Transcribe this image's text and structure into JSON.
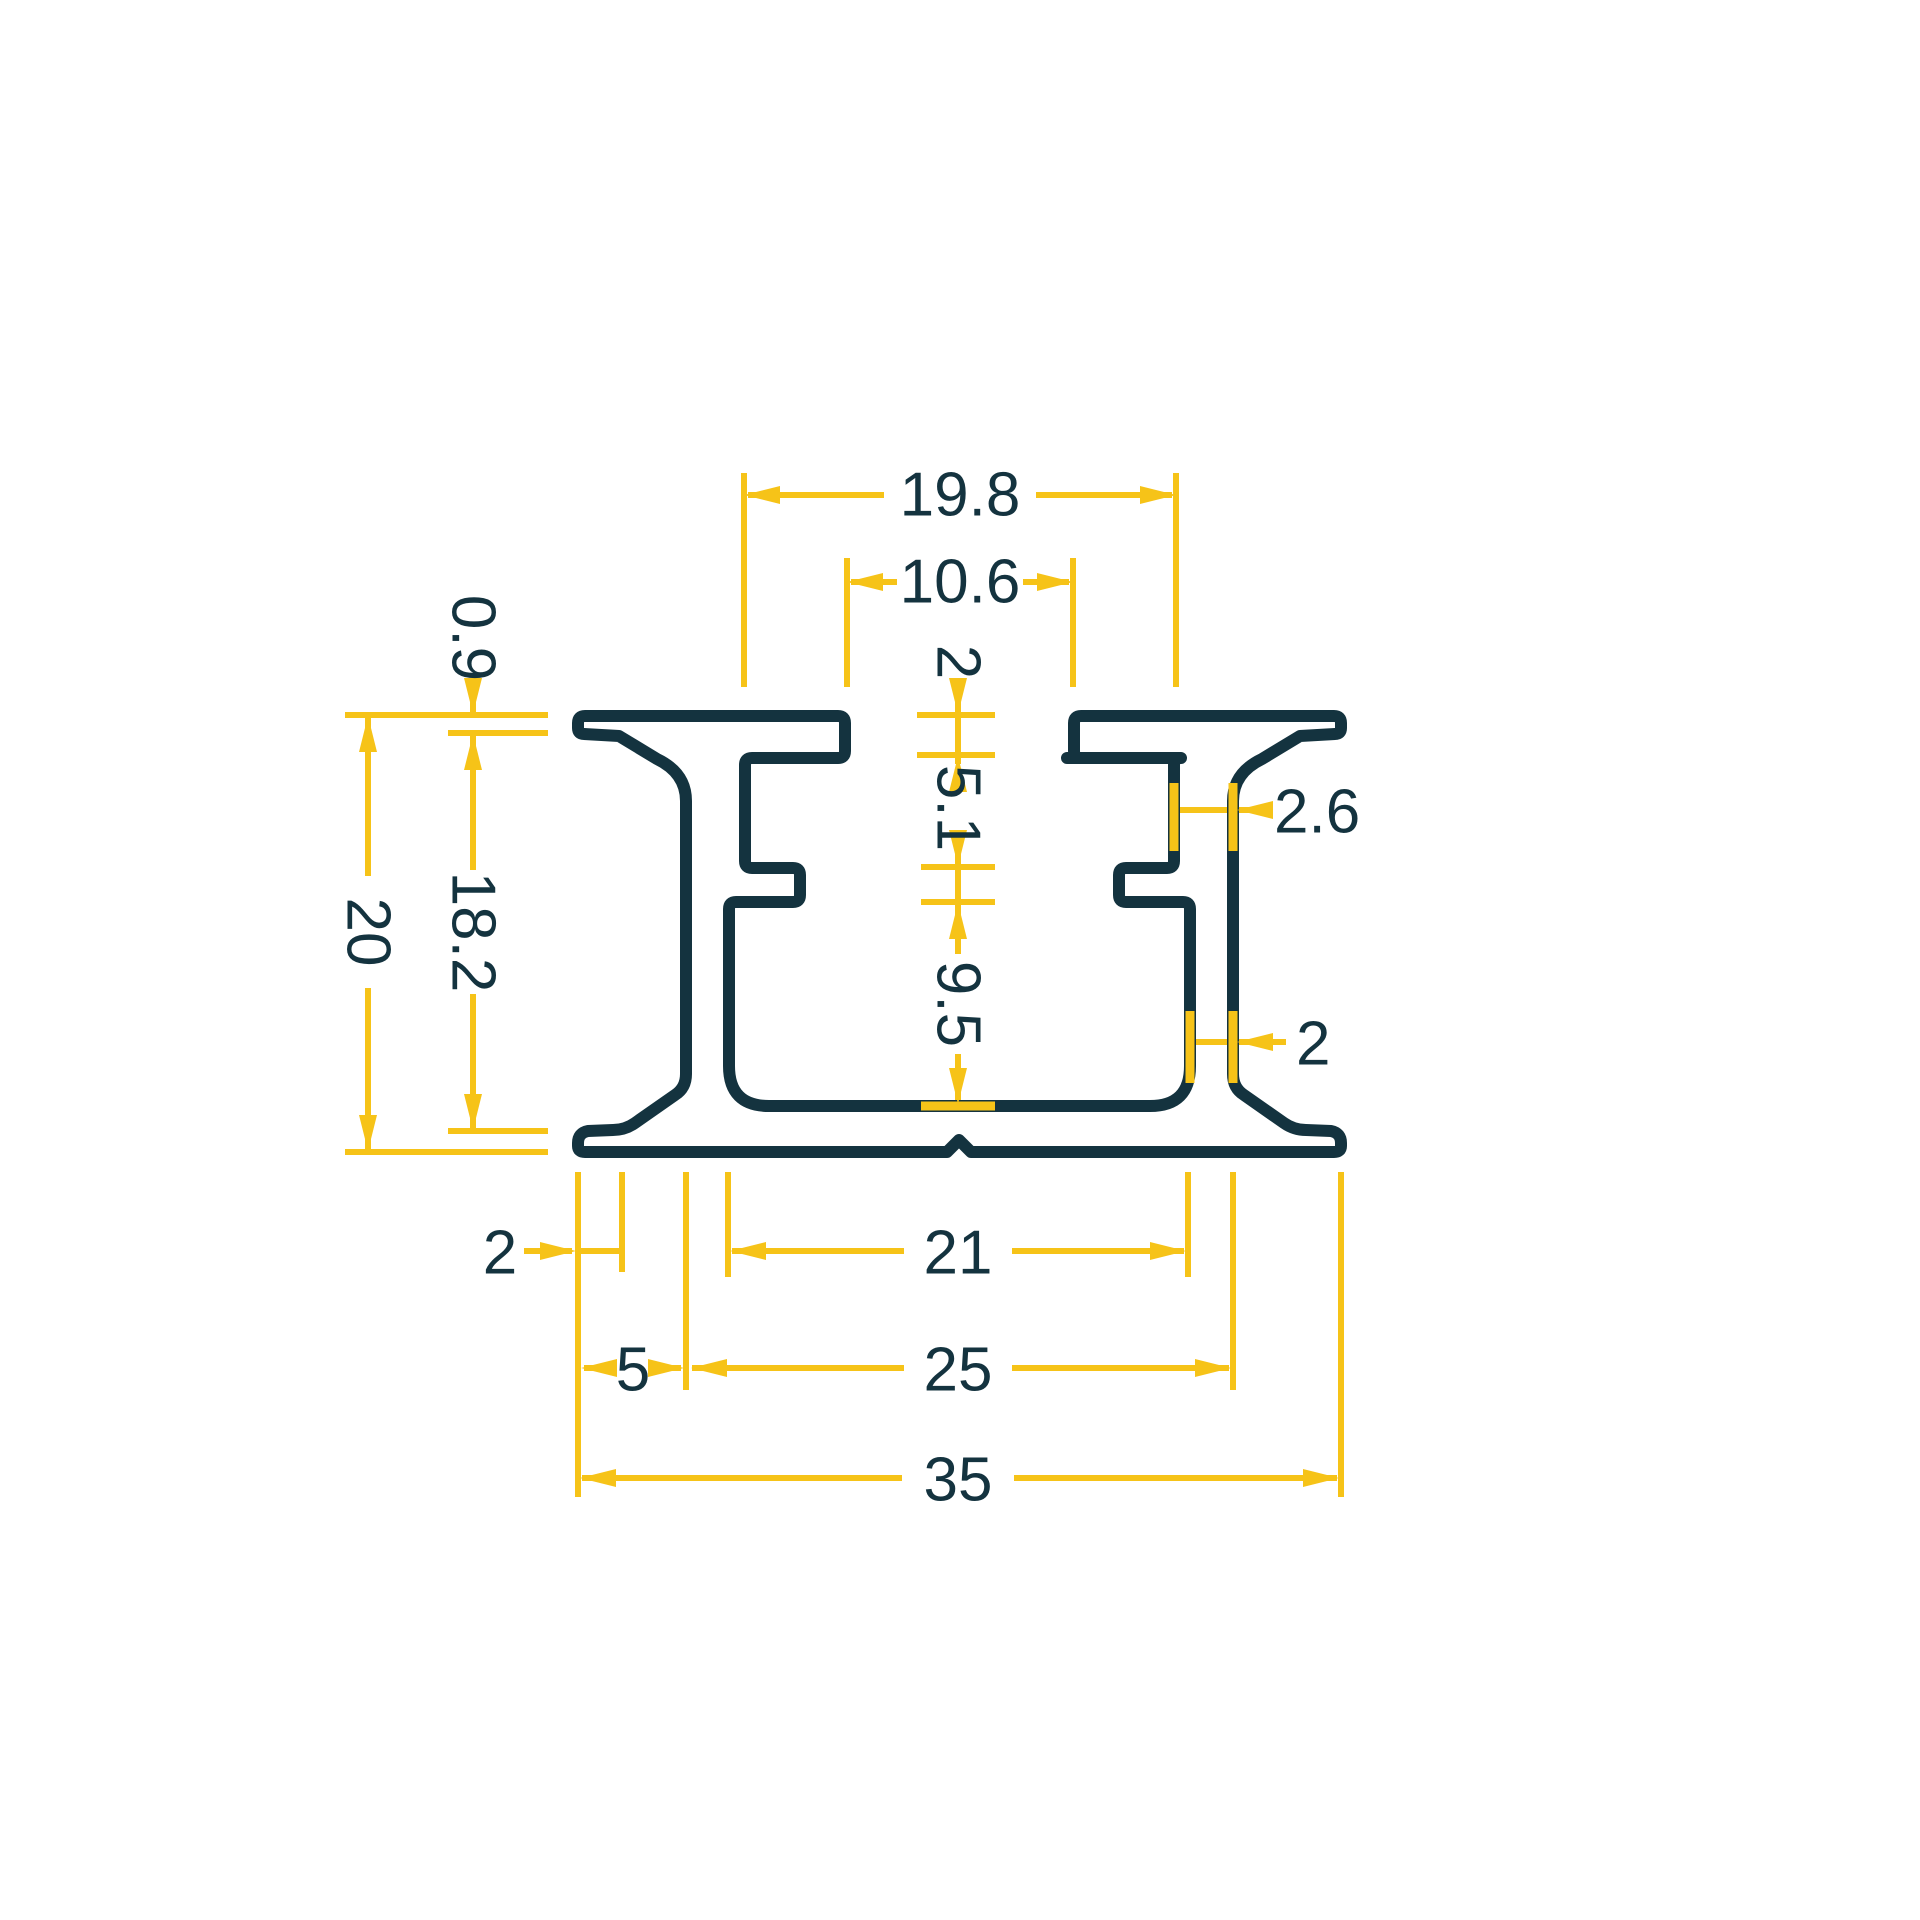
{
  "canvas": {
    "width": 1920,
    "height": 1920,
    "background": "#ffffff"
  },
  "colors": {
    "profile_stroke": "#14333F",
    "dimension": "#F6C318",
    "label_text": "#14333F"
  },
  "drawing": {
    "type": "extrusion-profile-cross-section",
    "profile_path": "M 585 716 L 838 716 Q 845 716 845 723 L 845 751 Q 845 758 838 758 L 752 758 Q 745 758 745 765 L 745 861 Q 745 868 752 868 L 793 868 Q 800 868 800 875 L 800 895 Q 800 902 793 902 L 736 902 Q 729 902 729 909 L 729 1066 Q 729 1106 769 1106 L 1150 1106 Q 1190 1106 1190 1066 L 1190 909 Q 1190 902 1183 902 L 1126 902 Q 1119 902 1119 895 L 1119 875 Q 1119 868 1126 868 L 1167 868 Q 1174 868 1174 861 L 1174 765 Q 1174 758 1181 758 L 1067 758 L 1081 758 Q 1074 758 1074 751 L 1074 723 Q 1074 716 1081 716 L 1334 716 Q 1341 716 1341 723 L 1341 728 Q 1341 734 1335 734 L 1300 736 L 1262 759 Q 1233 773 1233 801 L 1233 1074 Q 1233 1088 1244 1095 L 1284 1123 Q 1294 1130 1306 1130 L 1331 1131 Q 1341 1133 1341 1143 L 1341 1146 Q 1341 1152 1334 1152 L 971 1152 L 959 1140 L 947 1152 L 585 1152 Q 578 1152 578 1146 L 578 1143 Q 578 1133 588 1131 L 613 1130 Q 625 1130 635 1123 L 675 1095 Q 686 1088 686 1074 L 686 801 Q 686 773 657 759 L 619 736 L 584 734 Q 578 734 578 728 L 578 723 Q 578 716 585 716 Z",
    "profile_stroke_width": 12,
    "dim_stroke_width": 6,
    "highlight_stroke_width": 9,
    "arrow_length": 36,
    "arrow_half_width": 9
  },
  "dimensions_mm": [
    {
      "name": "channel-width-above-notches",
      "value": "19.8"
    },
    {
      "name": "top-opening-between-flange-tips",
      "value": "10.6"
    },
    {
      "name": "flange-thickness",
      "value": "2"
    },
    {
      "name": "slot-height-under-flange",
      "value": "5.1"
    },
    {
      "name": "flange-tip-thickness",
      "value": "0.9"
    },
    {
      "name": "upper-web-thickness",
      "value": "2.6"
    },
    {
      "name": "overall-height",
      "value": "20"
    },
    {
      "name": "height-under-flange-tip",
      "value": "18.2"
    },
    {
      "name": "lower-channel-height",
      "value": "9.5"
    },
    {
      "name": "lower-web-thickness",
      "value": "2"
    },
    {
      "name": "base-end-lip-length",
      "value": "2"
    },
    {
      "name": "channel-width-bottom",
      "value": "21"
    },
    {
      "name": "base-edge-to-web",
      "value": "5"
    },
    {
      "name": "width-across-webs",
      "value": "25"
    },
    {
      "name": "overall-width",
      "value": "35"
    }
  ],
  "labels": [
    {
      "text": "19.8",
      "x": 960,
      "y": 495,
      "rot": 0,
      "anchor": "middle"
    },
    {
      "text": "10.6",
      "x": 960,
      "y": 582,
      "rot": 0,
      "anchor": "middle"
    },
    {
      "text": "2",
      "x": 958,
      "y": 662,
      "rot": 90,
      "anchor": "middle"
    },
    {
      "text": "5.1",
      "x": 958,
      "y": 808,
      "rot": 90,
      "anchor": "middle"
    },
    {
      "text": "9.5",
      "x": 958,
      "y": 1004,
      "rot": 90,
      "anchor": "middle"
    },
    {
      "text": "0.9",
      "x": 473,
      "y": 638,
      "rot": 90,
      "anchor": "middle"
    },
    {
      "text": "20",
      "x": 368,
      "y": 932,
      "rot": 90,
      "anchor": "middle"
    },
    {
      "text": "18.2",
      "x": 473,
      "y": 932,
      "rot": 90,
      "anchor": "middle"
    },
    {
      "text": "2.6",
      "x": 1274,
      "y": 812,
      "rot": 0,
      "anchor": "start"
    },
    {
      "text": "2",
      "x": 1296,
      "y": 1044,
      "rot": 0,
      "anchor": "start"
    },
    {
      "text": "2",
      "x": 500,
      "y": 1253,
      "rot": 0,
      "anchor": "middle"
    },
    {
      "text": "21",
      "x": 958,
      "y": 1253,
      "rot": 0,
      "anchor": "middle"
    },
    {
      "text": "5",
      "x": 633,
      "y": 1370,
      "rot": 0,
      "anchor": "middle"
    },
    {
      "text": "25",
      "x": 958,
      "y": 1370,
      "rot": 0,
      "anchor": "middle"
    },
    {
      "text": "35",
      "x": 958,
      "y": 1480,
      "rot": 0,
      "anchor": "middle"
    }
  ],
  "dim_lines": [
    [
      748,
      495,
      884,
      495
    ],
    [
      1036,
      495,
      1172,
      495
    ],
    [
      851,
      582,
      897,
      582
    ],
    [
      1023,
      582,
      1069,
      582
    ],
    [
      958,
      680,
      958,
      764
    ],
    [
      958,
      852,
      958,
      954
    ],
    [
      958,
      1054,
      958,
      1102
    ],
    [
      473,
      680,
      473,
      712
    ],
    [
      473,
      736,
      473,
      870
    ],
    [
      473,
      994,
      473,
      1128
    ],
    [
      368,
      718,
      368,
      876
    ],
    [
      368,
      988,
      368,
      1149
    ],
    [
      1180,
      810,
      1262,
      810
    ],
    [
      1194,
      1042,
      1286,
      1042
    ],
    [
      524,
      1251,
      572,
      1251
    ],
    [
      578,
      1251,
      622,
      1251
    ],
    [
      732,
      1251,
      904,
      1251
    ],
    [
      1012,
      1251,
      1184,
      1251
    ],
    [
      584,
      1368,
      606,
      1368
    ],
    [
      660,
      1368,
      681,
      1368
    ],
    [
      692,
      1368,
      904,
      1368
    ],
    [
      1012,
      1368,
      1229,
      1368
    ],
    [
      582,
      1478,
      902,
      1478
    ],
    [
      1014,
      1478,
      1337,
      1478
    ]
  ],
  "ext_lines": [
    [
      744,
      473,
      744,
      687
    ],
    [
      1176,
      473,
      1176,
      687
    ],
    [
      847,
      558,
      847,
      687
    ],
    [
      1073,
      558,
      1073,
      687
    ],
    [
      345,
      715,
      548,
      715
    ],
    [
      448,
      733,
      548,
      733
    ],
    [
      448,
      1131,
      548,
      1131
    ],
    [
      345,
      1152,
      548,
      1152
    ],
    [
      917,
      715,
      995,
      715
    ],
    [
      917,
      755,
      995,
      755
    ],
    [
      921,
      867,
      995,
      867
    ],
    [
      921,
      902,
      995,
      902
    ],
    [
      578,
      1172,
      578,
      1497
    ],
    [
      622,
      1172,
      622,
      1272
    ],
    [
      686,
      1172,
      686,
      1390
    ],
    [
      728,
      1172,
      728,
      1277
    ],
    [
      1188,
      1172,
      1188,
      1277
    ],
    [
      1233,
      1172,
      1233,
      1390
    ],
    [
      1341,
      1172,
      1341,
      1497
    ]
  ],
  "highlights": [
    [
      921,
      1106,
      995,
      1106
    ],
    [
      1174,
      783,
      1174,
      851
    ],
    [
      1233,
      783,
      1233,
      851
    ],
    [
      1190,
      1011,
      1190,
      1083
    ],
    [
      1233,
      1011,
      1233,
      1083
    ]
  ],
  "arrows": [
    {
      "dir": "left",
      "x": 744,
      "y": 495
    },
    {
      "dir": "right",
      "x": 1176,
      "y": 495
    },
    {
      "dir": "left",
      "x": 847,
      "y": 582
    },
    {
      "dir": "right",
      "x": 1073,
      "y": 582
    },
    {
      "dir": "down",
      "x": 958,
      "y": 714
    },
    {
      "dir": "up",
      "x": 958,
      "y": 756
    },
    {
      "dir": "down",
      "x": 958,
      "y": 866
    },
    {
      "dir": "up",
      "x": 958,
      "y": 903
    },
    {
      "dir": "down",
      "x": 958,
      "y": 1104
    },
    {
      "dir": "down",
      "x": 473,
      "y": 714
    },
    {
      "dir": "up",
      "x": 473,
      "y": 734
    },
    {
      "dir": "down",
      "x": 473,
      "y": 1130
    },
    {
      "dir": "up",
      "x": 368,
      "y": 716
    },
    {
      "dir": "down",
      "x": 368,
      "y": 1151
    },
    {
      "dir": "left",
      "x": 1237,
      "y": 810
    },
    {
      "dir": "left",
      "x": 1237,
      "y": 1042
    },
    {
      "dir": "right",
      "x": 576,
      "y": 1251
    },
    {
      "dir": "left",
      "x": 730,
      "y": 1251
    },
    {
      "dir": "right",
      "x": 1186,
      "y": 1251
    },
    {
      "dir": "left",
      "x": 581,
      "y": 1368
    },
    {
      "dir": "right",
      "x": 684,
      "y": 1368
    },
    {
      "dir": "left",
      "x": 691,
      "y": 1368
    },
    {
      "dir": "right",
      "x": 1231,
      "y": 1368
    },
    {
      "dir": "left",
      "x": 580,
      "y": 1478
    },
    {
      "dir": "right",
      "x": 1339,
      "y": 1478
    }
  ]
}
